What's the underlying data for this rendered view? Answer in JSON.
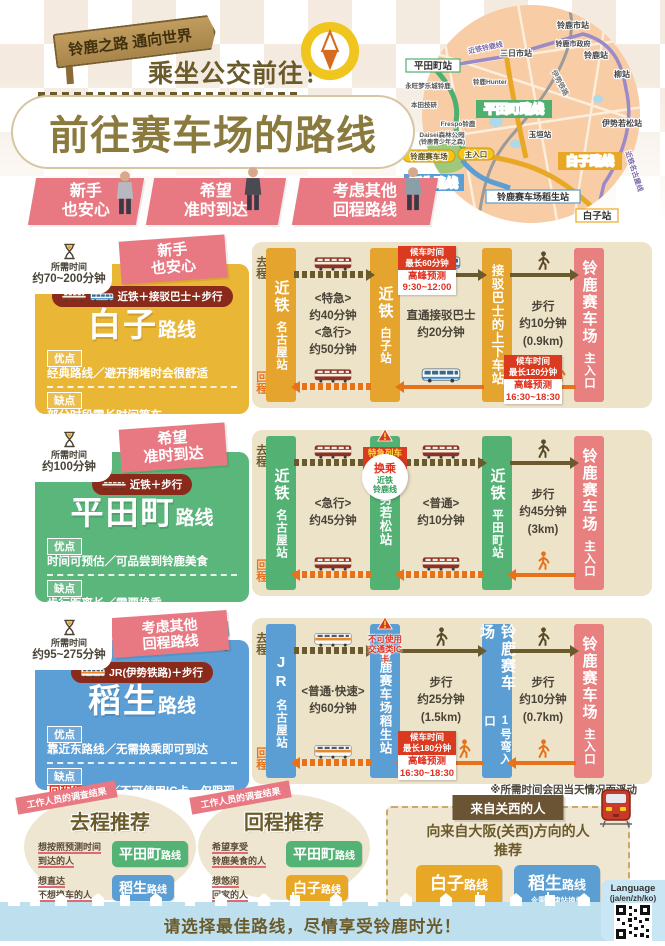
{
  "header": {
    "sign": "铃鹿之路 通向世界",
    "subtitle": "乘坐公交前往！",
    "title": "前往赛车场的路线"
  },
  "ribbons": [
    {
      "line1": "新手",
      "line2": "也安心"
    },
    {
      "line1": "希望",
      "line2": "准时到达"
    },
    {
      "line1": "考虑其他",
      "line2": "回程路线"
    }
  ],
  "map": {
    "hiratacho_sta": "平田町站",
    "suzukashi_sta": "铃鹿市站",
    "mikkaichi_sta": "三日市站",
    "city_hall": "铃鹿市政府",
    "suzuka_sta": "铃鹿站",
    "yanagi_sta": "柳站",
    "isewakamatsu_sta": "伊势若松站",
    "tamagaki_sta": "玉垣站",
    "shiroko_sta": "白子站",
    "inou_sta": "铃鹿赛车场稻生站",
    "line_suzuka": "近铁铃鹿线",
    "line_ise": "伊势铁路",
    "line_nagoya": "近铁名古屋线",
    "route_hiratacho": "平田町路线",
    "route_shiroko": "白子路线",
    "route_inou": "稻生路线",
    "circuit": "铃鹿赛车场",
    "main_gate": "主入口",
    "park1": "Daisei森林公园",
    "park2": "(铃鹿青少年之森)",
    "aeon": "永旺梦乐城铃鹿",
    "honda": "本田技研",
    "frespo": "Frespo铃鹿",
    "hunter": "铃鹿Hunter"
  },
  "legend": {
    "go": "去程",
    "back": "回程"
  },
  "routes": [
    {
      "time_prefix": "所需时间",
      "time": "约70~200分钟",
      "tag1": "新手",
      "tag2": "也安心",
      "mode": "近铁＋接驳巴士＋步行",
      "name": "白子",
      "name_suffix": "路线",
      "pros_label": "优点",
      "pros": "经典路线／避开拥堵时会很舒适",
      "cons_label": "缺点",
      "cons": "部分时段需长时间等车",
      "stations": [
        {
          "name": "近铁",
          "sub": "名古屋站"
        },
        {
          "name": "近铁",
          "sub": "白子站"
        },
        {
          "name": "接驳巴士的上下车站",
          "sub": ""
        },
        {
          "name": "铃鹿赛车场",
          "sub": "主入口"
        }
      ],
      "segments": [
        {
          "times": [
            "<特急>",
            "约40分钟",
            "<急行>",
            "约50分钟"
          ]
        },
        {
          "times": [
            "直通接驳巴士",
            "约20分钟"
          ],
          "go_badge": {
            "head": "候车时间",
            "max": "最长60分钟",
            "peak": "高峰预测",
            "range": "9:30~12:00"
          }
        },
        {
          "times": [
            "步行",
            "约10分钟",
            "(0.9km)"
          ],
          "back_badge": {
            "head": "候车时间",
            "max": "最长120分钟",
            "peak": "高峰预测",
            "range": "16:30~18:30"
          }
        }
      ]
    },
    {
      "time_prefix": "所需时间",
      "time": "约100分钟",
      "tag1": "希望",
      "tag2": "准时到达",
      "mode": "近铁＋步行",
      "name": "平田町",
      "name_suffix": "路线",
      "pros_label": "优点",
      "pros": "时间可预估／可品尝到铃鹿美食",
      "cons_label": "缺点",
      "cons": "步行距离长／需要换乘",
      "warn": "特急列车不停靠",
      "transfer": {
        "l1": "换乘",
        "l2": "近铁",
        "l3": "铃鹿线"
      },
      "stations": [
        {
          "name": "近铁",
          "sub": "名古屋站"
        },
        {
          "name": "伊势若松站",
          "sub": ""
        },
        {
          "name": "近铁",
          "sub": "平田町站"
        },
        {
          "name": "铃鹿赛车场",
          "sub": "主入口"
        }
      ],
      "segments": [
        {
          "times": [
            "<急行>",
            "约45分钟"
          ]
        },
        {
          "times": [
            "<普通>",
            "约10分钟"
          ]
        },
        {
          "times": [
            "步行",
            "约45分钟",
            "(3km)"
          ]
        }
      ]
    },
    {
      "time_prefix": "所需时间",
      "time": "约95~275分钟",
      "tag1": "考虑其他",
      "tag2": "回程路线",
      "mode": "JR(伊势铁路)＋步行",
      "name": "稻生",
      "name_suffix": "路线",
      "pros_label": "优点",
      "pros": "靠近东路线／无需换乘即可到达",
      "cons_label": "缺点",
      "cons_highlight": "回程很拥挤",
      "cons": "／不可使用IC卡，仅限现金",
      "warn": "不可使用交通类IC卡",
      "stations": [
        {
          "name": "JR",
          "sub": "名古屋站"
        },
        {
          "name": "铃鹿赛车场稻生站",
          "sub": ""
        },
        {
          "name": "铃鹿赛车场",
          "sub": "1号弯入口"
        },
        {
          "name": "铃鹿赛车场",
          "sub": "主入口"
        }
      ],
      "segments": [
        {
          "times": [
            "<普通·快速>",
            "约60分钟"
          ]
        },
        {
          "times": [
            "步行",
            "约25分钟",
            "(1.5km)"
          ],
          "back_badge": {
            "head": "候车时间",
            "max": "最长180分钟",
            "peak": "高峰预测",
            "range": "16:30~18:30"
          }
        },
        {
          "times": [
            "步行",
            "约10分钟",
            "(0.7km)"
          ]
        }
      ]
    }
  ],
  "note": "※所需时间会因当天情况而浮动",
  "survey_ribbon": "工作人员的调查结果",
  "recommend_go": {
    "title": "去程推荐",
    "items": [
      {
        "cond1": "想按照预测时间",
        "cond2": "到达的人",
        "route": "平田町",
        "suffix": "路线"
      },
      {
        "cond1": "想直达",
        "cond2": "不想换车的人",
        "route": "稻生",
        "suffix": "路线"
      }
    ]
  },
  "recommend_back": {
    "title": "回程推荐",
    "items": [
      {
        "cond1": "希望享受",
        "cond2": "铃鹿美食的人",
        "route": "平田町",
        "suffix": "路线"
      },
      {
        "cond1": "想悠闲",
        "cond2": "回家的人",
        "route": "白子",
        "suffix": "路线"
      }
    ]
  },
  "kansai": {
    "banner": "来自关西的人",
    "line1": "向来自大阪(关西)方向的人",
    "line2": "推荐",
    "buttons": [
      {
        "name": "白子",
        "suffix": "路线"
      },
      {
        "name": "稻生",
        "suffix": "路线",
        "note": "※需在津站换乘"
      }
    ]
  },
  "footer": {
    "message": "请选择最佳路线，尽情享受铃鹿时光！",
    "language_label": "Language",
    "language_options": "(ja/en/zh/ko)"
  }
}
